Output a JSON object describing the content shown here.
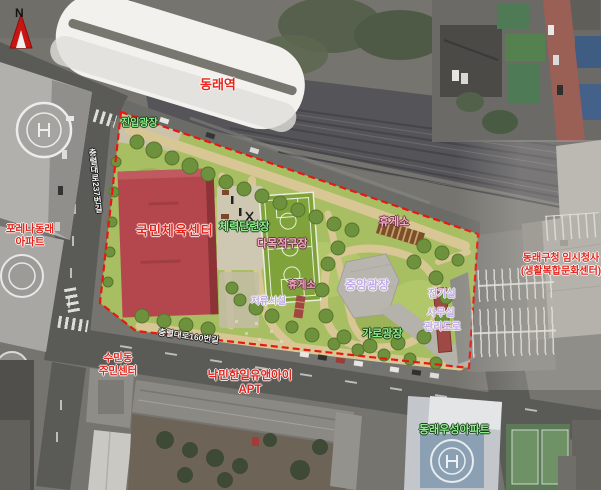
{
  "compass": {
    "label": "N"
  },
  "station": {
    "label": "동래역"
  },
  "park": {
    "entrance_plaza": "진입광장",
    "sports_center": "국민체육센터",
    "fitness_area": "체력단련장",
    "multipurpose_court": "다목적구장",
    "shelter_top": "휴게소",
    "shelter_court": "휴게소",
    "central_plaza": "중앙광장",
    "street_plaza": "가로광장",
    "detention_facility": "저류시설",
    "electrical_room": "전기실",
    "office": "사무실",
    "service_road": "관리도로"
  },
  "surroundings": {
    "forena_apt_line1": "포레나동래",
    "forena_apt_line2": "아파트",
    "sumin_center_line1": "수민동",
    "sumin_center_line2": "주민센터",
    "nakmin_apt_line1": "낙민한일유앤아이",
    "nakmin_apt_line2": "APT",
    "temp_hall_line1": "동래구청 임시청사",
    "temp_hall_line2": "(생활복합문화센터)",
    "woosung_apt": "동래우성아파트",
    "road_south": "충렬대로160번길",
    "road_west": "충렬대로237번길"
  },
  "colors": {
    "site_boundary": "#e8170f",
    "park_grass": "#a8be62",
    "sports_center_building": "#b4474d",
    "court_green": "#7fa23b",
    "path_tan": "#d8c795",
    "plaza_gray": "#b7b5ad",
    "label_red": "#e3251c",
    "label_green": "#8df08c",
    "label_pink": "#f5a9c4",
    "label_purple": "#bfa9e8"
  }
}
